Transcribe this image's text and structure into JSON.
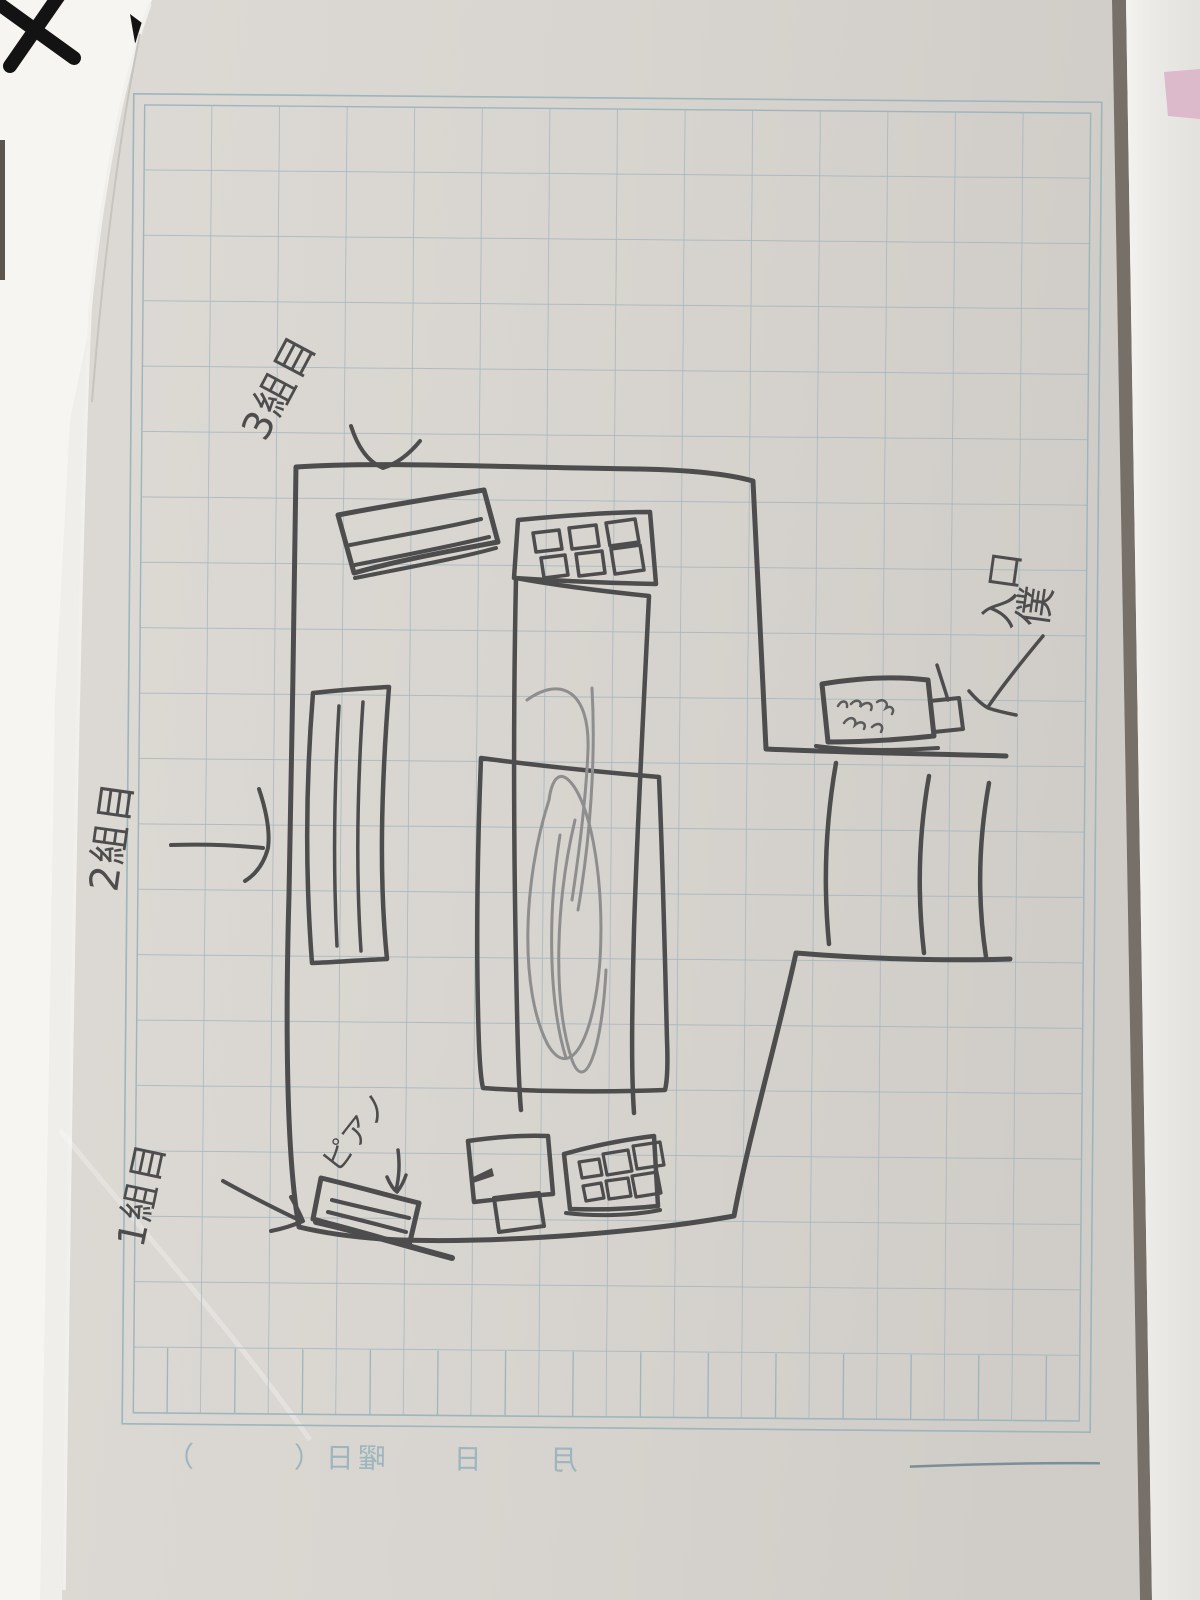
{
  "sketch_labels": {
    "group3": "3組目",
    "group2": "2組目",
    "group1": "1組目",
    "piano": "ピアノ",
    "entrance": "入口",
    "me": "僕"
  },
  "printed_footer": {
    "date_line": "月　　日　　曜日（　　　）"
  },
  "colors": {
    "pen": "#4d4d4d",
    "pencil_light": "#8e8e8e",
    "grid_line": "#9db5bd",
    "page": "#d8d4cf",
    "page_dark": "#d2cec9",
    "right_page": "#eceae6",
    "pink_tab": "#dcb9cb",
    "marker_black": "#131313",
    "seam": "#767069"
  }
}
